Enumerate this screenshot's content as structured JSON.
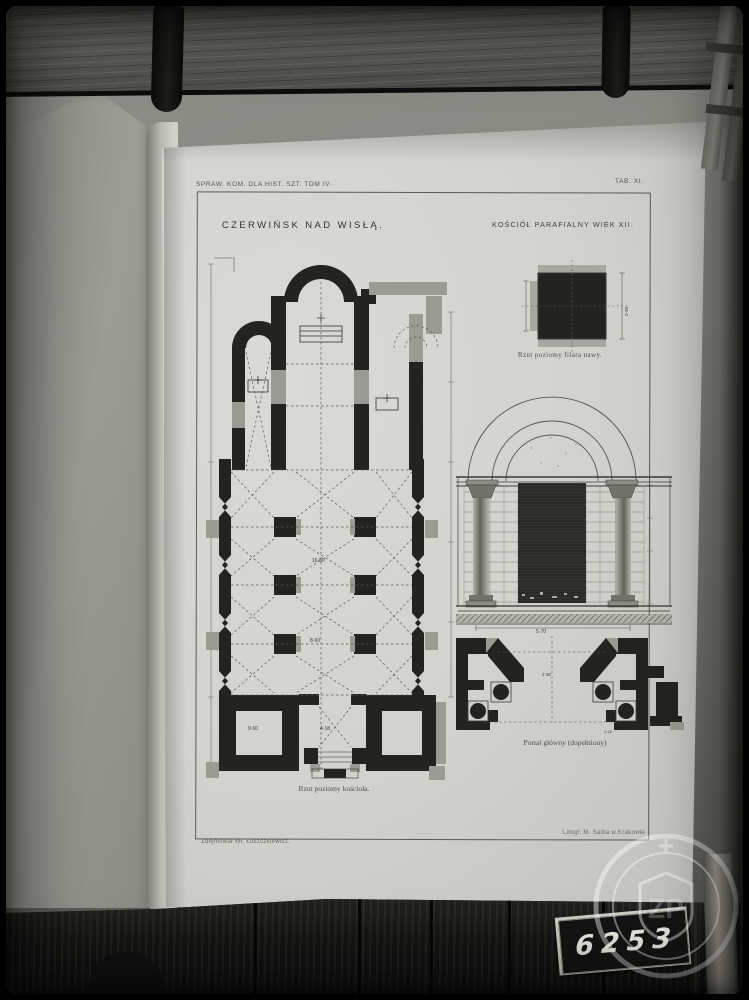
{
  "photo": {
    "inventory_number": "6253",
    "watermark_monogram": "ZP"
  },
  "page": {
    "header_left": "SPRAW. KOM. DLA HIST. SZT. TOM IV.",
    "header_right": "TAB. XI.",
    "title_left": "CZERWIŃSK NAD WISŁĄ.",
    "title_right": "KOŚCIÓŁ PARAFIALNY WIEK XII.",
    "caption_floor_plan": "Rzut poziomy kościoła.",
    "caption_pillar_plan": "Rzut poziomy filara nawy.",
    "caption_portal": "Portal główny (dopełniony)",
    "credit_left": "Zdejmował Wł. Łuszczkiewicz.",
    "credit_right": "Litogr. M. Salba w Krakowie",
    "dims": {
      "nave_length": "16·50",
      "nave_width": "8·60",
      "tower_room": "9·60",
      "entry_width": "4·18",
      "portal_span": "5·70",
      "portal_opening": "2·30",
      "portal_jamb": "1·42"
    }
  },
  "colors": {
    "paper": "#d6d6d0",
    "ink": "#232320",
    "reconstruction_gray": "#9b9b93",
    "wood_dark": "#191916",
    "board_gray": "#5b5b56"
  }
}
